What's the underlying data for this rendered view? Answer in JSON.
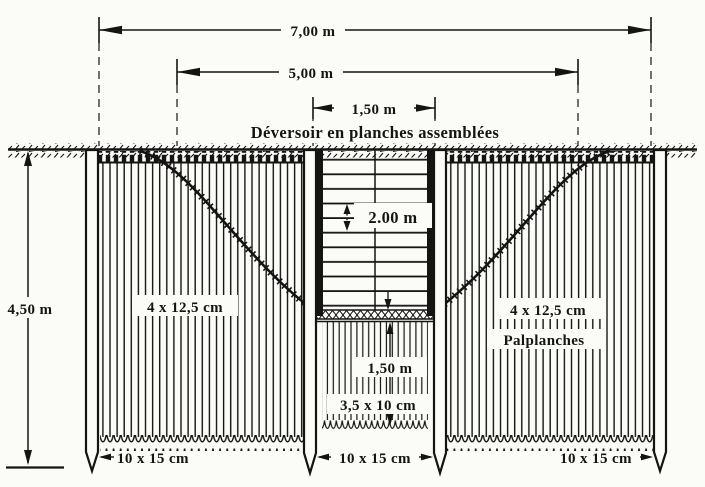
{
  "title": "Déversoir en planches assemblées",
  "dimensions": {
    "overall_width": "7,00 m",
    "inner_width": "5,00 m",
    "weir_width": "1,50  m",
    "excavation_depth": "4,50 m",
    "weir_depth": "2.00 m",
    "central_sheet_length": "1,50 m"
  },
  "labels": {
    "left_sheet_size": "4 x 12,5 cm",
    "right_sheet_size": "4 x 12,5 cm",
    "sheet_piles_name": "Palplanches",
    "central_sheet_size": "3,5 x 10 cm",
    "left_post_size": "10 x 15 cm",
    "center_post_size": "10 x 15 cm",
    "right_post_size": "10 x 15 cm"
  },
  "colors": {
    "ink": "#151412",
    "paper": "#fbfbf8"
  }
}
